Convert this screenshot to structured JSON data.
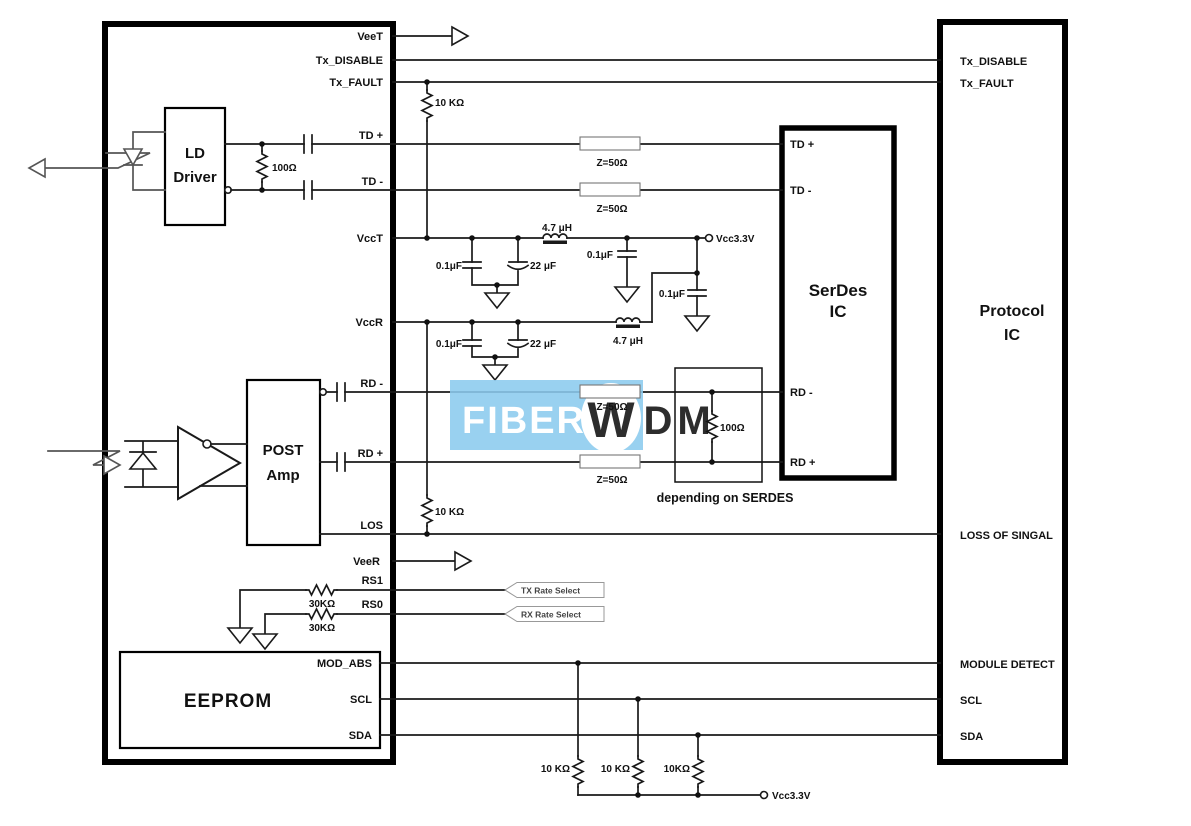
{
  "colors": {
    "wire": "#1a1a1a",
    "watermark_blue": "#8ccbee",
    "watermark_red": "#ea8f8f",
    "watermark_orange": "#f3b283",
    "watermark_yellow": "#ecd87d",
    "z_label_red": "#8f3a3a"
  },
  "watermark": {
    "fiber": "FIBER",
    "w": "W",
    "d": "D",
    "m": "M"
  },
  "module": {
    "pins": {
      "veet": "VeeT",
      "tx_disable": "Tx_DISABLE",
      "tx_fault": "Tx_FAULT",
      "td_p": "TD +",
      "td_m": "TD -",
      "vcct": "VccT",
      "vccr": "VccR",
      "rd_m": "RD -",
      "rd_p": "RD +",
      "los": "LOS",
      "veer": "VeeR",
      "rs1": "RS1",
      "rs0": "RS0"
    },
    "ld_driver": {
      "line1": "LD",
      "line2": "Driver"
    },
    "post_amp": {
      "line1": "POST",
      "line2": "Amp"
    },
    "eeprom": {
      "title": "EEPROM",
      "pins": {
        "mod_abs": "MOD_ABS",
        "scl": "SCL",
        "sda": "SDA"
      }
    }
  },
  "serdes": {
    "title1": "SerDes",
    "title2": "IC",
    "pins": {
      "td_p": "TD +",
      "td_m": "TD -",
      "rd_m": "RD -",
      "rd_p": "RD +"
    },
    "note": "depending on SERDES"
  },
  "protocol": {
    "title1": "Protocol",
    "title2": "IC",
    "pins": {
      "tx_disable": "Tx_DISABLE",
      "tx_fault": "Tx_FAULT",
      "los": "LOSS OF SINGAL",
      "module_detect": "MODULE DETECT",
      "scl": "SCL",
      "sda": "SDA"
    }
  },
  "components": {
    "r_txfault_pullup": "10 KΩ",
    "r_td_term": "100Ω",
    "z_td_p": "Z=50Ω",
    "z_td_m": "Z=50Ω",
    "z_rd_m": "Z=50Ω",
    "z_rd_p": "Z=50Ω",
    "c_vcct_1": "0.1μF",
    "c_vcct_2": "22 μF",
    "l_vcct": "4.7 μH",
    "c_vcct_3": "0.1μF",
    "c_vccr_filter": "0.1μF",
    "c_vccr_1": "0.1μF",
    "c_vccr_2": "22 μF",
    "l_vccr": "4.7 μH",
    "r_los_pullup": "10 KΩ",
    "r_rs1": "30KΩ",
    "r_rs0": "30KΩ",
    "r_rd_term": "100Ω",
    "r_i2c_1": "10 KΩ",
    "r_i2c_2": "10 KΩ",
    "r_i2c_3": "10KΩ",
    "vcc_top": "Vcc3.3V",
    "vcc_bottom": "Vcc3.3V",
    "tx_rate_tag": "TX Rate Select",
    "rx_rate_tag": "RX Rate Select"
  }
}
